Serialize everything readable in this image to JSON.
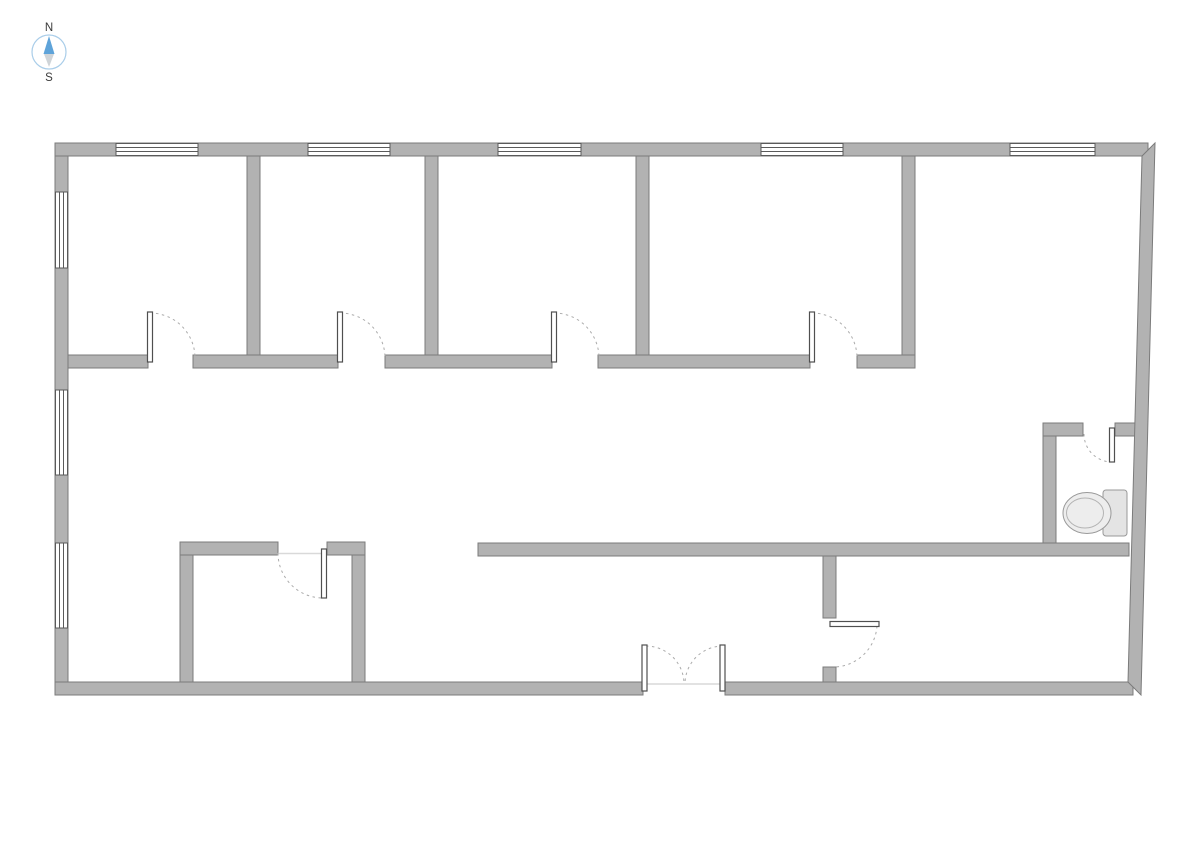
{
  "compass": {
    "north_label": "N",
    "south_label": "S",
    "center": [
      49,
      52
    ],
    "radius": 17,
    "ring_color": "#a9cde9",
    "needle_north_color": "#5ea3d9",
    "needle_south_color": "#cfd4d8",
    "label_color": "#3a3a3a"
  },
  "palette": {
    "background": "#ffffff",
    "wall_fill": "#b2b2b2",
    "wall_outline": "#7b7b7b",
    "window_fill": "#ffffff",
    "window_line": "#5a5a5a",
    "door_leaf_fill": "#ffffff",
    "door_leaf_outline": "#4f4f4f",
    "door_arc": "#ababab",
    "threshold_line": "#d9d9d9",
    "fixture_fill": "#ededed",
    "fixture_fill_dark": "#e4e4e4",
    "fixture_outline": "#999999",
    "fixture_inner_line": "#b3b3b3"
  },
  "plan": {
    "canvas": [
      1191,
      842
    ],
    "walls": [
      {
        "name": "exterior-wall-left",
        "r": [
          55,
          143,
          13,
          552
        ]
      },
      {
        "name": "exterior-wall-top",
        "r": [
          55,
          143,
          1093,
          13
        ]
      },
      {
        "name": "exterior-wall-bottom-left",
        "r": [
          55,
          682,
          588,
          13
        ]
      },
      {
        "name": "exterior-wall-bottom-right",
        "r": [
          725,
          682,
          408,
          13
        ]
      },
      {
        "name": "partition-room1-room2",
        "r": [
          247,
          156,
          13,
          199
        ]
      },
      {
        "name": "partition-room2-room3",
        "r": [
          425,
          156,
          13,
          199
        ]
      },
      {
        "name": "partition-room3-room4",
        "r": [
          636,
          156,
          13,
          199
        ]
      },
      {
        "name": "partition-room4-room5",
        "r": [
          902,
          156,
          13,
          199
        ]
      },
      {
        "name": "corridor-wall-seg-1",
        "r": [
          68,
          355,
          80,
          13
        ]
      },
      {
        "name": "corridor-wall-seg-2",
        "r": [
          193,
          355,
          145,
          13
        ]
      },
      {
        "name": "corridor-wall-seg-3",
        "r": [
          385,
          355,
          167,
          13
        ]
      },
      {
        "name": "corridor-wall-seg-4",
        "r": [
          598,
          355,
          212,
          13
        ]
      },
      {
        "name": "corridor-wall-seg-5",
        "r": [
          857,
          355,
          58,
          13
        ]
      },
      {
        "name": "central-wall",
        "r": [
          478,
          543,
          651,
          13
        ]
      },
      {
        "name": "right-room-wall-upper",
        "r": [
          823,
          556,
          13,
          62
        ]
      },
      {
        "name": "right-room-wall-lower",
        "r": [
          823,
          667,
          13,
          15
        ]
      },
      {
        "name": "bottomleft-room-top-seg-1",
        "r": [
          180,
          542,
          98,
          13
        ]
      },
      {
        "name": "bottomleft-room-top-seg-2",
        "r": [
          327,
          542,
          38,
          13
        ]
      },
      {
        "name": "bottomleft-room-wall-left",
        "r": [
          180,
          555,
          13,
          127
        ]
      },
      {
        "name": "bottomleft-room-wall-right",
        "r": [
          352,
          555,
          13,
          127
        ]
      },
      {
        "name": "bathroom-wall-left",
        "r": [
          1043,
          423,
          13,
          120
        ]
      },
      {
        "name": "bathroom-top-seg-1",
        "r": [
          1043,
          423,
          40,
          13
        ]
      },
      {
        "name": "bathroom-top-seg-2",
        "r": [
          1115,
          423,
          29,
          13
        ]
      }
    ],
    "right_wall_points": "1155,143 1141,695 1128,682 1142,156",
    "windows_horizontal": [
      {
        "name": "window-top-1",
        "x": 116,
        "y": 143.5,
        "len": 82
      },
      {
        "name": "window-top-2",
        "x": 308,
        "y": 143.5,
        "len": 82
      },
      {
        "name": "window-top-3",
        "x": 498,
        "y": 143.5,
        "len": 83
      },
      {
        "name": "window-top-4",
        "x": 761,
        "y": 143.5,
        "len": 82
      },
      {
        "name": "window-top-5",
        "x": 1010,
        "y": 143.5,
        "len": 85
      }
    ],
    "windows_vertical": [
      {
        "name": "window-left-1",
        "x": 55.5,
        "y": 192,
        "len": 76
      },
      {
        "name": "window-left-2",
        "x": 55.5,
        "y": 390,
        "len": 85
      },
      {
        "name": "window-left-3",
        "x": 55.5,
        "y": 543,
        "len": 85
      }
    ],
    "door_leaves": [
      {
        "name": "door-leaf-room1",
        "r": [
          147.5,
          312,
          5,
          50
        ]
      },
      {
        "name": "door-leaf-room2",
        "r": [
          337.5,
          312,
          5,
          50
        ]
      },
      {
        "name": "door-leaf-room3",
        "r": [
          551.5,
          312,
          5,
          50
        ]
      },
      {
        "name": "door-leaf-room4",
        "r": [
          809.5,
          312,
          5,
          50
        ]
      },
      {
        "name": "door-leaf-bottomleft",
        "r": [
          321.5,
          549,
          5,
          49
        ]
      },
      {
        "name": "door-leaf-rightroom",
        "r": [
          830,
          621.5,
          49,
          5
        ]
      },
      {
        "name": "door-leaf-bathroom",
        "r": [
          1109.5,
          428,
          5,
          34
        ]
      },
      {
        "name": "door-leaf-double-left",
        "r": [
          642,
          645,
          5,
          46
        ]
      },
      {
        "name": "door-leaf-double-right",
        "r": [
          720,
          645,
          5,
          46
        ]
      }
    ],
    "door_arcs": [
      {
        "name": "door-arc-room1",
        "d": "M 150,313 A 45 45 0 0 1 195,358"
      },
      {
        "name": "door-arc-room2",
        "d": "M 340,313 A 45 45 0 0 1 385,358"
      },
      {
        "name": "door-arc-room3",
        "d": "M 554,313 A 45 45 0 0 1 599,358"
      },
      {
        "name": "door-arc-room4",
        "d": "M 812,313 A 45 45 0 0 1 857,358"
      },
      {
        "name": "door-arc-bottomleft",
        "d": "M 278,553 A 45 45 0 0 0 323,598"
      },
      {
        "name": "door-arc-rightroom",
        "d": "M 877,626 A 44 44 0 0 1 834,667"
      },
      {
        "name": "door-arc-bathroom",
        "d": "M 1084,434 A 28 28 0 0 0 1112,462"
      },
      {
        "name": "door-arc-double-left",
        "d": "M 646,646 A 38 38 0 0 1 684,684"
      },
      {
        "name": "door-arc-double-right",
        "d": "M 723,646 A 38 38 0 0 0 685,684"
      }
    ],
    "thresholds": [
      {
        "name": "threshold-bottomleft-door",
        "x1": 278,
        "y1": 553.5,
        "x2": 327,
        "y2": 553.5
      },
      {
        "name": "threshold-double-door",
        "x1": 647,
        "y1": 684,
        "x2": 722,
        "y2": 684
      }
    ],
    "toilet": {
      "tank": [
        1103,
        490,
        24,
        46
      ],
      "bowl": {
        "cx": 1087,
        "cy": 513,
        "rx": 24,
        "ry": 20.5
      },
      "seat": {
        "cx": 1085,
        "cy": 513,
        "rx": 18.5,
        "ry": 15
      }
    }
  }
}
